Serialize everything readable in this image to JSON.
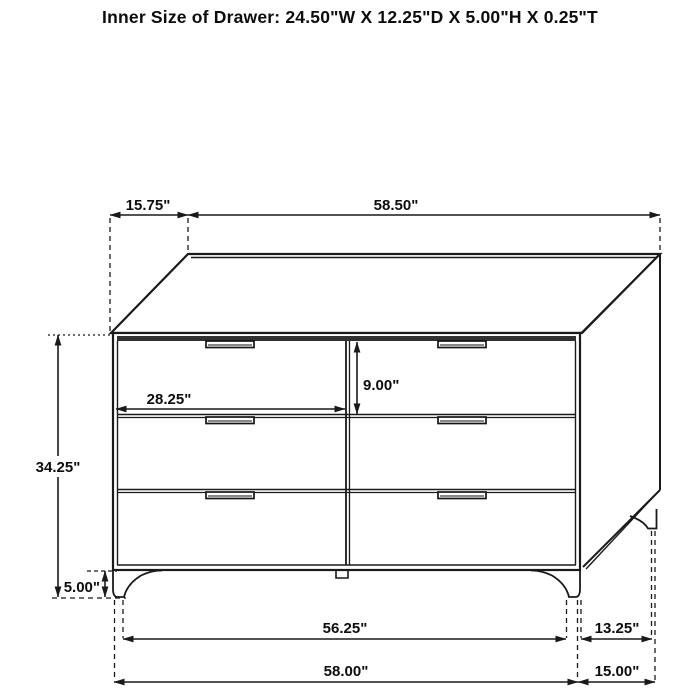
{
  "title": "Inner Size of Drawer: 24.50\"W X 12.25\"D X 5.00\"H X 0.25\"T",
  "colors": {
    "line": "#1a1a1a",
    "text": "#0d0d0d",
    "background": "#ffffff"
  },
  "dimensions": {
    "top_depth_offset": "15.75\"",
    "top_width": "58.50\"",
    "drawer_width": "28.25\"",
    "drawer_height": "9.00\"",
    "overall_height": "34.25\"",
    "leg_height": "5.00\"",
    "leg_span_width": "56.25\"",
    "overall_width": "58.00\"",
    "leg_span_depth": "13.25\"",
    "overall_depth": "15.00\""
  }
}
